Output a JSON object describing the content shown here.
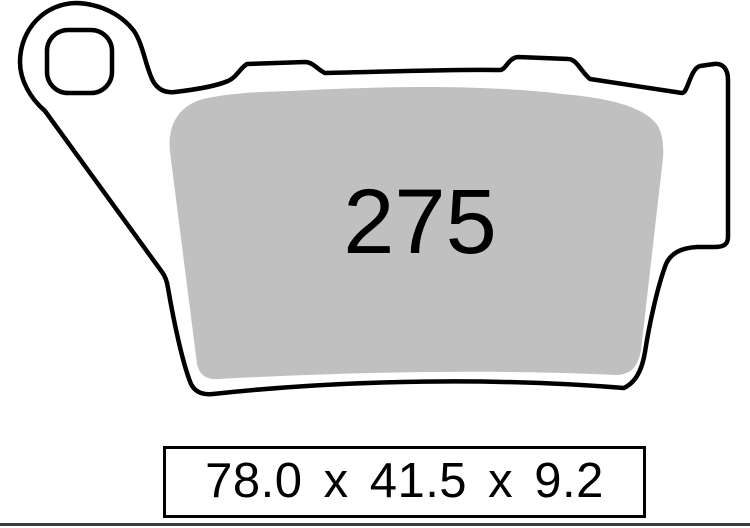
{
  "part": {
    "pad_number": "275",
    "dimensions": "78.0 x 41.5 x 9.2"
  },
  "colors": {
    "outline": "#000000",
    "friction_material": "#c0c0c0",
    "background": "#ffffff",
    "separator_line": "#3c3c3c"
  }
}
